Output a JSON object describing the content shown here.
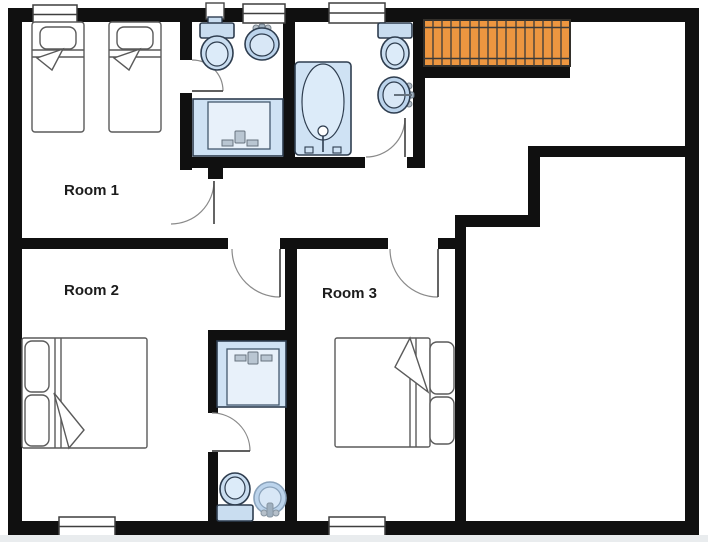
{
  "diagram_type": "floor-plan",
  "rooms": [
    {
      "label": "Room 1"
    },
    {
      "label": "Room 2"
    },
    {
      "label": "Room 3"
    }
  ],
  "fixture_symbols": [
    "twin-bed-icon",
    "twin-bed-icon",
    "double-bed-icon",
    "double-bed-icon",
    "toilet-icon",
    "toilet-icon",
    "toilet-icon",
    "sink-icon",
    "sink-icon",
    "sink-icon",
    "bathtub-icon",
    "vanity-icon",
    "vanity-icon",
    "stairs-icon",
    "window-icon",
    "door-swing-icon"
  ],
  "counts": {
    "labeled_rooms": 3,
    "bathrooms": 3,
    "beds": 4,
    "windows": 5,
    "doors": 6,
    "staircases": 1
  },
  "colors": {
    "wall": "#101010",
    "fixture_fill": "#cfe2f4",
    "fixture_fill_dark": "#bcd4ec",
    "fixture_fill_light": "#e8f1fa",
    "fixture_stroke": "#2e3d4f",
    "furniture_stroke": "#5a5a5a",
    "stairs_fill": "#ed9640",
    "background": "#ffffff",
    "footer_strip": "#e9ecee"
  }
}
